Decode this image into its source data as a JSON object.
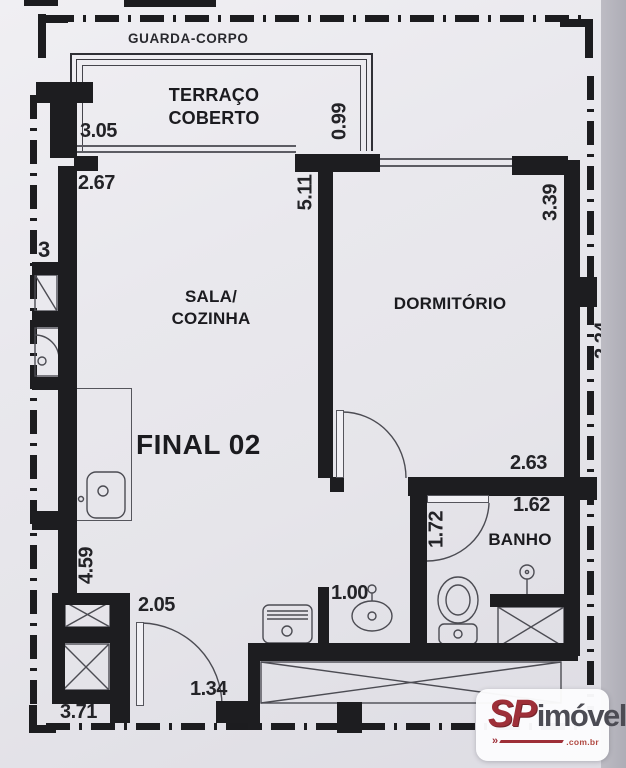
{
  "plan": {
    "guard_rail_label": "GUARDA-CORPO",
    "unit_label": "FINAL 02",
    "rooms": {
      "terraco": {
        "name_line1": "TERRAÇO",
        "name_line2": "COBERTO",
        "width": "3.05",
        "depth": "0.99"
      },
      "sala_cozinha": {
        "name_line1": "SALA/",
        "name_line2": "COZINHA",
        "width": "2.67",
        "depth": "5.11"
      },
      "dormitorio": {
        "name": "DORMITÓRIO",
        "depth": "3.39",
        "width": "2.63"
      },
      "banho": {
        "name": "BANHO",
        "width": "1.62",
        "door_side": "1.72"
      }
    },
    "dimensions": {
      "counter_wall": "4.59",
      "kitchen_width": "2.05",
      "sink_counter": "1.00",
      "entry_opening": "1.34",
      "bottom_edge": "3.71",
      "left_edge_partial": "3",
      "right_edge_partial": "2.24"
    }
  },
  "watermark": {
    "brand_prefix": "SP",
    "brand_suffix": "imóvel",
    "brand_domain": ".com.br",
    "accent_color": "#9e2f38",
    "suffix_color": "#4c4c54"
  }
}
